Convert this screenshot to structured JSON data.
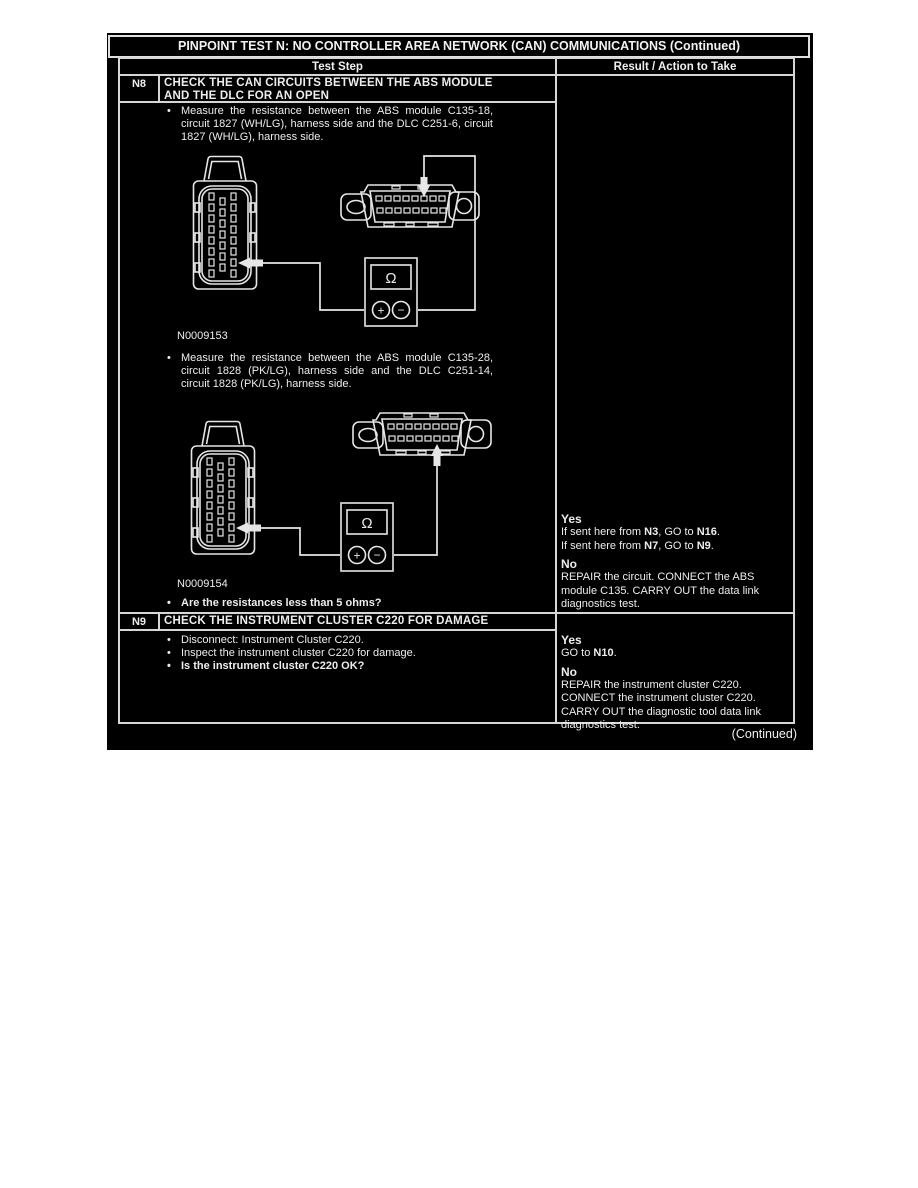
{
  "page": {
    "title": "PINPOINT TEST N: NO CONTROLLER AREA NETWORK (CAN) COMMUNICATIONS (Continued)",
    "continued": "(Continued)"
  },
  "table_header": {
    "test_step": "Test Step",
    "result": "Result / Action to Take"
  },
  "steps": {
    "n8": {
      "id": "N8",
      "title": "CHECK THE CAN CIRCUITS BETWEEN THE ABS MODULE AND THE DLC FOR AN OPEN",
      "bullets": {
        "measure1": "Measure the resistance between the ABS module C135-18, circuit 1827 (WH/LG), harness side and the DLC C251-6, circuit 1827 (WH/LG), harness side.",
        "measure2": "Measure the resistance between the ABS module C135-28, circuit 1828 (PK/LG), harness side and the DLC C251-14, circuit 1828 (PK/LG), harness side.",
        "question": "Are the resistances less than 5 ohms?"
      },
      "figure1": {
        "label": "N0009153",
        "ohm_symbol": "Ω",
        "plus": "+",
        "minus": "−"
      },
      "figure2": {
        "label": "N0009154",
        "ohm_symbol": "Ω",
        "plus": "+",
        "minus": "−"
      },
      "result": {
        "yes_label": "Yes",
        "yes_lines": [
          [
            {
              "t": "If sent here from "
            },
            {
              "t": "N3",
              "b": true
            },
            {
              "t": ", GO to "
            },
            {
              "t": "N16",
              "b": true
            },
            {
              "t": "."
            }
          ],
          [
            {
              "t": "If sent here from "
            },
            {
              "t": "N7",
              "b": true
            },
            {
              "t": ", GO to "
            },
            {
              "t": "N9",
              "b": true
            },
            {
              "t": "."
            }
          ]
        ],
        "no_label": "No",
        "no_text": "REPAIR the circuit. CONNECT the ABS module C135. CARRY OUT the data link diagnostics test."
      }
    },
    "n9": {
      "id": "N9",
      "title": "CHECK THE INSTRUMENT CLUSTER C220 FOR DAMAGE",
      "bullets": {
        "b1": "Disconnect: Instrument Cluster C220.",
        "b2": "Inspect the instrument cluster C220 for damage.",
        "question": "Is the instrument cluster C220 OK?"
      },
      "result": {
        "yes_label": "Yes",
        "yes_lines": [
          [
            {
              "t": "GO to "
            },
            {
              "t": "N10",
              "b": true
            },
            {
              "t": "."
            }
          ]
        ],
        "no_label": "No",
        "no_text": "REPAIR the instrument cluster C220. CONNECT the instrument cluster C220. CARRY OUT the diagnostic tool data link diagnostics test."
      }
    }
  }
}
